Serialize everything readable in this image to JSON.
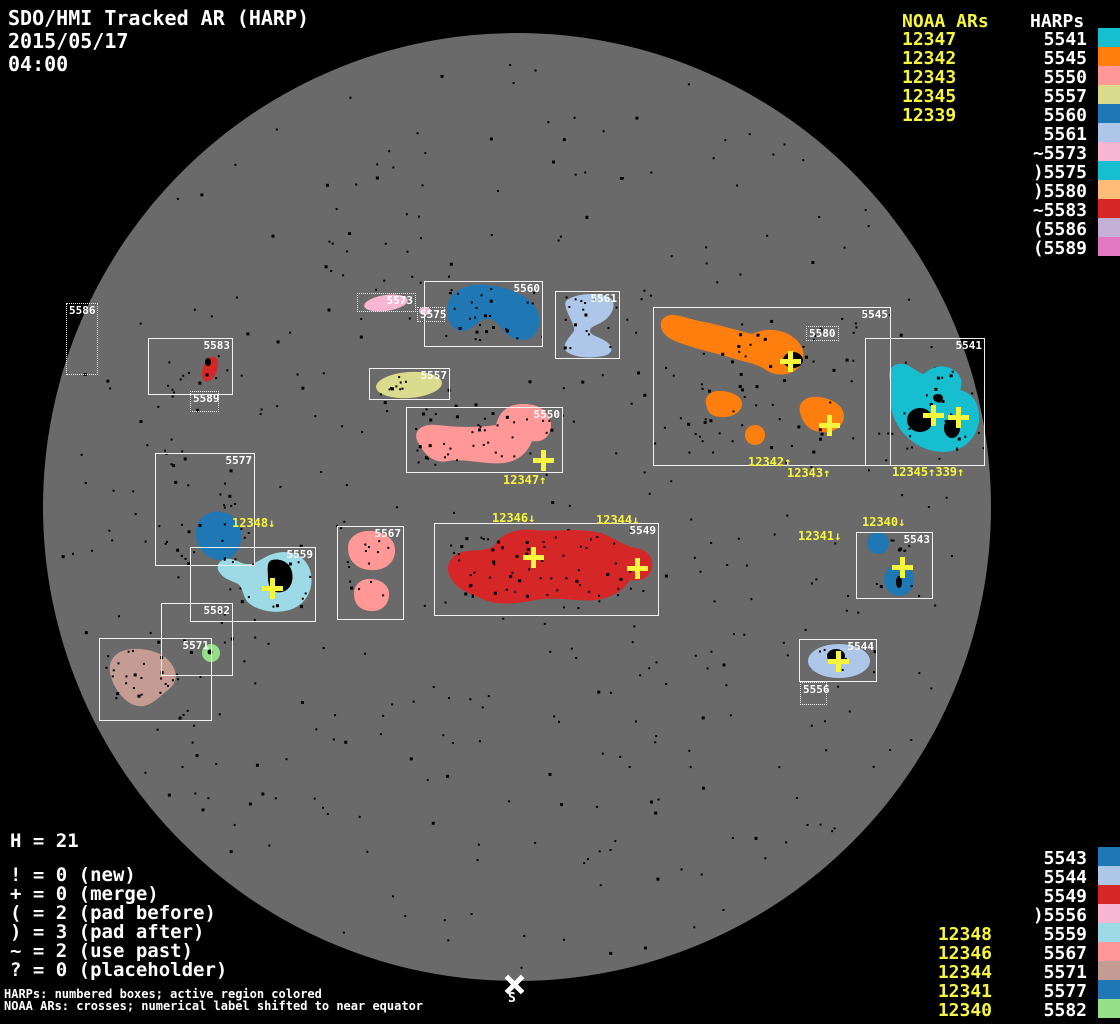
{
  "title": {
    "line1": "SDO/HMI Tracked AR (HARP)",
    "date": "2015/05/17",
    "time": "04:00"
  },
  "top_right": {
    "noaa_header": "NOAA ARs",
    "harps_header": "HARPs",
    "noaa_list": [
      "12347",
      "12342",
      "12343",
      "12345",
      "12339"
    ],
    "harps_list": [
      {
        "label": "5541",
        "harp": "5541"
      },
      {
        "label": "5545",
        "harp": "5545"
      },
      {
        "label": "5550",
        "harp": "5550"
      },
      {
        "label": "5557",
        "harp": "5557"
      },
      {
        "label": "5560",
        "harp": "5560"
      },
      {
        "label": "5561",
        "harp": "5561"
      },
      {
        "label": "~5573",
        "harp": "5573"
      },
      {
        "label": ")5575",
        "harp": "5575"
      },
      {
        "label": ")5580",
        "harp": "5580"
      },
      {
        "label": "~5583",
        "harp": "5583"
      },
      {
        "label": "(5586",
        "harp": "5586"
      },
      {
        "label": "(5589",
        "harp": "5589"
      }
    ]
  },
  "bottom_right": {
    "harps_list": [
      {
        "label": "5543",
        "harp": "5543"
      },
      {
        "label": "5544",
        "harp": "5544"
      },
      {
        "label": "5549",
        "harp": "5549"
      },
      {
        "label": ")5556",
        "harp": "5556"
      },
      {
        "label": "5559",
        "harp": "5559"
      },
      {
        "label": "5567",
        "harp": "5567"
      },
      {
        "label": "5571",
        "harp": "5571"
      },
      {
        "label": "5577",
        "harp": "5577"
      },
      {
        "label": "5582",
        "harp": "5582"
      }
    ],
    "noaa_list": [
      "12348",
      "12346",
      "12344",
      "12341",
      "12340"
    ]
  },
  "legend": {
    "h_line": "H = 21",
    "lines": [
      "! = 0 (new)",
      "+ = 0 (merge)",
      "( = 2 (pad before)",
      ") = 3 (pad after)",
      "~ = 2 (use past)",
      "? = 0 (placeholder)"
    ]
  },
  "footer": {
    "line1": "HARPs: numbered boxes; active region colored",
    "line2": "NOAA ARs: crosses; numerical label shifted to near equator"
  },
  "south_marker": "S",
  "colors": {
    "yellow": "#f6f63c",
    "white": "#ffffff",
    "disk": "#6a6a6a",
    "background": "#000000",
    "harp_colors": {
      "5541": "#17becf",
      "5543": "#1f77b4",
      "5544": "#aec7e8",
      "5545": "#ff7f0e",
      "5549": "#d62728",
      "5550": "#ff9896",
      "5556": "#f7b6d2",
      "5557": "#dbdb8d",
      "5559": "#9edae5",
      "5560": "#1f77b4",
      "5561": "#aec7e8",
      "5567": "#ff9896",
      "5571": "#c49c94",
      "5573": "#f7b6d2",
      "5575": "#17becf",
      "5577": "#1f77b4",
      "5580": "#ffbb78",
      "5582": "#98df8a",
      "5583": "#d62728",
      "5586": "#c5b0d5",
      "5589": "#e377c2"
    }
  },
  "disk_geometry": {
    "cx": 517,
    "cy": 507,
    "r": 474
  },
  "regions": {
    "boxes": [
      {
        "harp": "5586",
        "x": 66,
        "y": 303,
        "w": 32,
        "h": 72,
        "dotted": true,
        "align": "tl"
      },
      {
        "harp": "5583",
        "x": 148,
        "y": 338,
        "w": 85,
        "h": 57,
        "dotted": false,
        "align": "tr"
      },
      {
        "harp": "5589",
        "x": 190,
        "y": 391,
        "w": 29,
        "h": 21,
        "dotted": true,
        "align": "tl"
      },
      {
        "harp": "5573",
        "x": 357,
        "y": 293,
        "w": 59,
        "h": 19,
        "dotted": true,
        "align": "tr"
      },
      {
        "harp": "5575",
        "x": 417,
        "y": 307,
        "w": 28,
        "h": 15,
        "dotted": true,
        "align": "tl"
      },
      {
        "harp": "5560",
        "x": 424,
        "y": 281,
        "w": 119,
        "h": 66,
        "dotted": false,
        "align": "tr"
      },
      {
        "harp": "5561",
        "x": 555,
        "y": 291,
        "w": 65,
        "h": 68,
        "dotted": false,
        "align": "tr"
      },
      {
        "harp": "5557",
        "x": 369,
        "y": 368,
        "w": 81,
        "h": 32,
        "dotted": false,
        "align": "tr"
      },
      {
        "harp": "5550",
        "x": 406,
        "y": 407,
        "w": 157,
        "h": 66,
        "dotted": false,
        "align": "tr"
      },
      {
        "harp": "5577",
        "x": 155,
        "y": 453,
        "w": 100,
        "h": 113,
        "dotted": false,
        "align": "tr"
      },
      {
        "harp": "5559",
        "x": 190,
        "y": 547,
        "w": 126,
        "h": 75,
        "dotted": false,
        "align": "tr"
      },
      {
        "harp": "5582",
        "x": 161,
        "y": 603,
        "w": 72,
        "h": 73,
        "dotted": false,
        "align": "tr"
      },
      {
        "harp": "5571",
        "x": 99,
        "y": 638,
        "w": 113,
        "h": 83,
        "dotted": false,
        "align": "tr"
      },
      {
        "harp": "5567",
        "x": 337,
        "y": 526,
        "w": 67,
        "h": 94,
        "dotted": false,
        "align": "tr"
      },
      {
        "harp": "5549",
        "x": 434,
        "y": 523,
        "w": 225,
        "h": 93,
        "dotted": false,
        "align": "tr"
      },
      {
        "harp": "5545",
        "x": 653,
        "y": 307,
        "w": 238,
        "h": 159,
        "dotted": false,
        "align": "tr"
      },
      {
        "harp": "5580",
        "x": 806,
        "y": 326,
        "w": 33,
        "h": 15,
        "dotted": true,
        "align": "tl"
      },
      {
        "harp": "5541",
        "x": 865,
        "y": 338,
        "w": 120,
        "h": 128,
        "dotted": false,
        "align": "tr"
      },
      {
        "harp": "5543",
        "x": 856,
        "y": 532,
        "w": 77,
        "h": 67,
        "dotted": false,
        "align": "tr"
      },
      {
        "harp": "5544",
        "x": 799,
        "y": 639,
        "w": 78,
        "h": 43,
        "dotted": false,
        "align": "tr"
      },
      {
        "harp": "5556",
        "x": 800,
        "y": 682,
        "w": 27,
        "h": 23,
        "dotted": true,
        "align": "tl"
      }
    ],
    "crosses": [
      {
        "noaa": "12347",
        "x": 543,
        "y": 460
      },
      {
        "noaa": "12348",
        "x": 272,
        "y": 588
      },
      {
        "noaa": "12346",
        "x": 533,
        "y": 557
      },
      {
        "noaa": "12344",
        "x": 637,
        "y": 568
      },
      {
        "noaa": "12342",
        "x": 790,
        "y": 361
      },
      {
        "noaa": "12343",
        "x": 829,
        "y": 425
      },
      {
        "noaa": "12345",
        "x": 933,
        "y": 415
      },
      {
        "noaa": "12339",
        "x": 958,
        "y": 417
      },
      {
        "noaa": "12340",
        "x": 902,
        "y": 567
      },
      {
        "noaa": "12341",
        "x": 838,
        "y": 661
      }
    ],
    "noaa_labels": [
      {
        "text": "12347↑",
        "x": 503,
        "y": 474
      },
      {
        "text": "12348↓",
        "x": 232,
        "y": 517
      },
      {
        "text": "12346↓",
        "x": 492,
        "y": 512
      },
      {
        "text": "12344↓",
        "x": 596,
        "y": 514
      },
      {
        "text": "12342↑",
        "x": 748,
        "y": 456
      },
      {
        "text": "12343↑",
        "x": 787,
        "y": 467
      },
      {
        "text": "12345↑339↑",
        "x": 892,
        "y": 466
      },
      {
        "text": "12340↓",
        "x": 862,
        "y": 516
      },
      {
        "text": "12341↓",
        "x": 798,
        "y": 530
      }
    ]
  }
}
